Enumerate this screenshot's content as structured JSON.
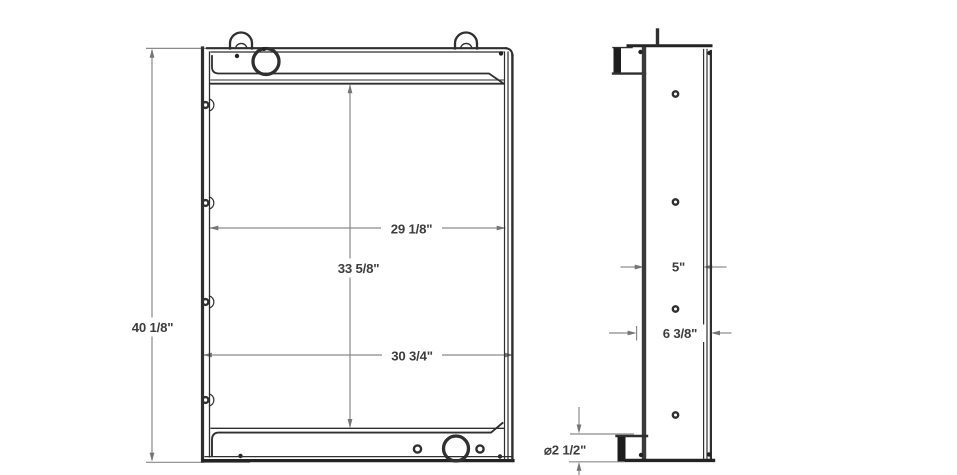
{
  "drawing": {
    "front_view": {
      "overall_height": "40 1/8\"",
      "core_width": "29 1/8\"",
      "core_height": "33 5/8\"",
      "overall_width": "30 3/4\""
    },
    "side_view": {
      "core_depth": "5\"",
      "overall_depth": "6 3/8\"",
      "outlet_diameter": "⌀2 1/2\""
    },
    "colors": {
      "object_line": "#2f2f2f",
      "dimension_line": "#8a8a8a",
      "label_text": "#3d3d3d",
      "background": "#ffffff"
    }
  }
}
